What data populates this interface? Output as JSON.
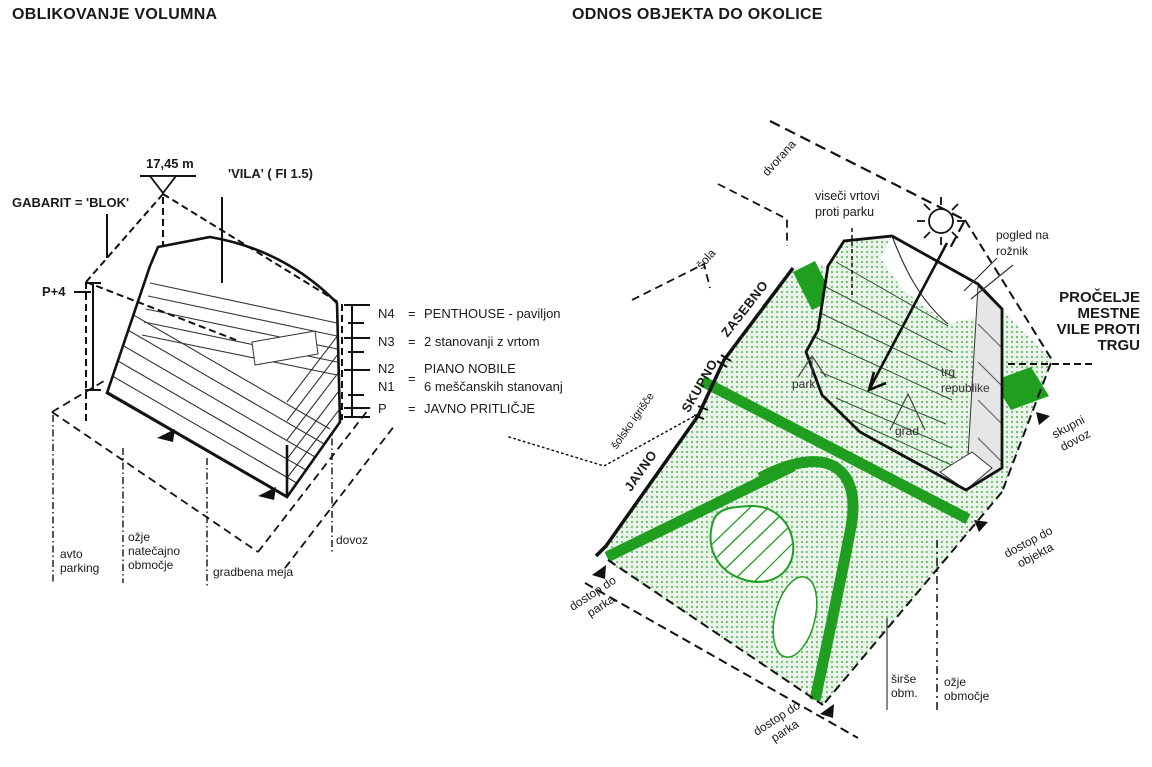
{
  "left_panel": {
    "title": "OBLIKOVANJE VOLUMNA",
    "labels": {
      "height": "17,45 m",
      "vila": "'VILA' ( FI 1.5)",
      "gabarit": "GABARIT = 'BLOK'",
      "floors": "P+4",
      "avto_parking": [
        "avto",
        "parking"
      ],
      "ozje_natecajno": [
        "ožje",
        "natečajno",
        "območje"
      ],
      "gradbena_meja": "gradbena meja",
      "dovoz": "dovoz"
    },
    "legend": {
      "rows": [
        {
          "key": "N4",
          "eq": "=",
          "text": "PENTHOUSE - paviljon"
        },
        {
          "key": "N3",
          "eq": "=",
          "text": "2 stanovanji z vrtom"
        }
      ],
      "combo": {
        "key1": "N2",
        "key2": "N1",
        "eq": "=",
        "text1": "PIANO NOBILE",
        "text2": "6 meščanskih stanovanj"
      },
      "p_row": {
        "key": "P",
        "eq": "=",
        "text": "JAVNO PRITLIČJE"
      }
    }
  },
  "right_panel": {
    "title": "ODNOS OBJEKTA DO OKOLICE",
    "zones": {
      "javno": "JAVNO",
      "skupno": "SKUPNO",
      "zasebno": "ZASEBNO"
    },
    "context": {
      "dvorana": "dvorana",
      "sola": "šola",
      "solsko_igrisce": "šolsko igrišče"
    },
    "labels": {
      "viseci": [
        "viseči vrtovi",
        "proti parku"
      ],
      "pogled": [
        "pogled na",
        "rožnik"
      ],
      "procelje": [
        "PROČELJE",
        "MESTNE",
        "VILE PROTI",
        "TRGU"
      ],
      "park": "park",
      "grad": "grad",
      "trg": [
        "trg",
        "republike"
      ],
      "skupni_dovoz": [
        "skupni",
        "dovoz"
      ],
      "dostop_objekt": [
        "dostop do",
        "objekta"
      ],
      "dostop_parka": [
        "dostop do",
        "parka"
      ],
      "sirse": [
        "širše",
        "obm."
      ],
      "ozje": [
        "ožje",
        "območje"
      ]
    },
    "colors": {
      "green": "#1f9e1f",
      "green_dot": "#58ae58",
      "green_bg": "#eaf5ea",
      "facade": "#e6e6e6"
    }
  }
}
